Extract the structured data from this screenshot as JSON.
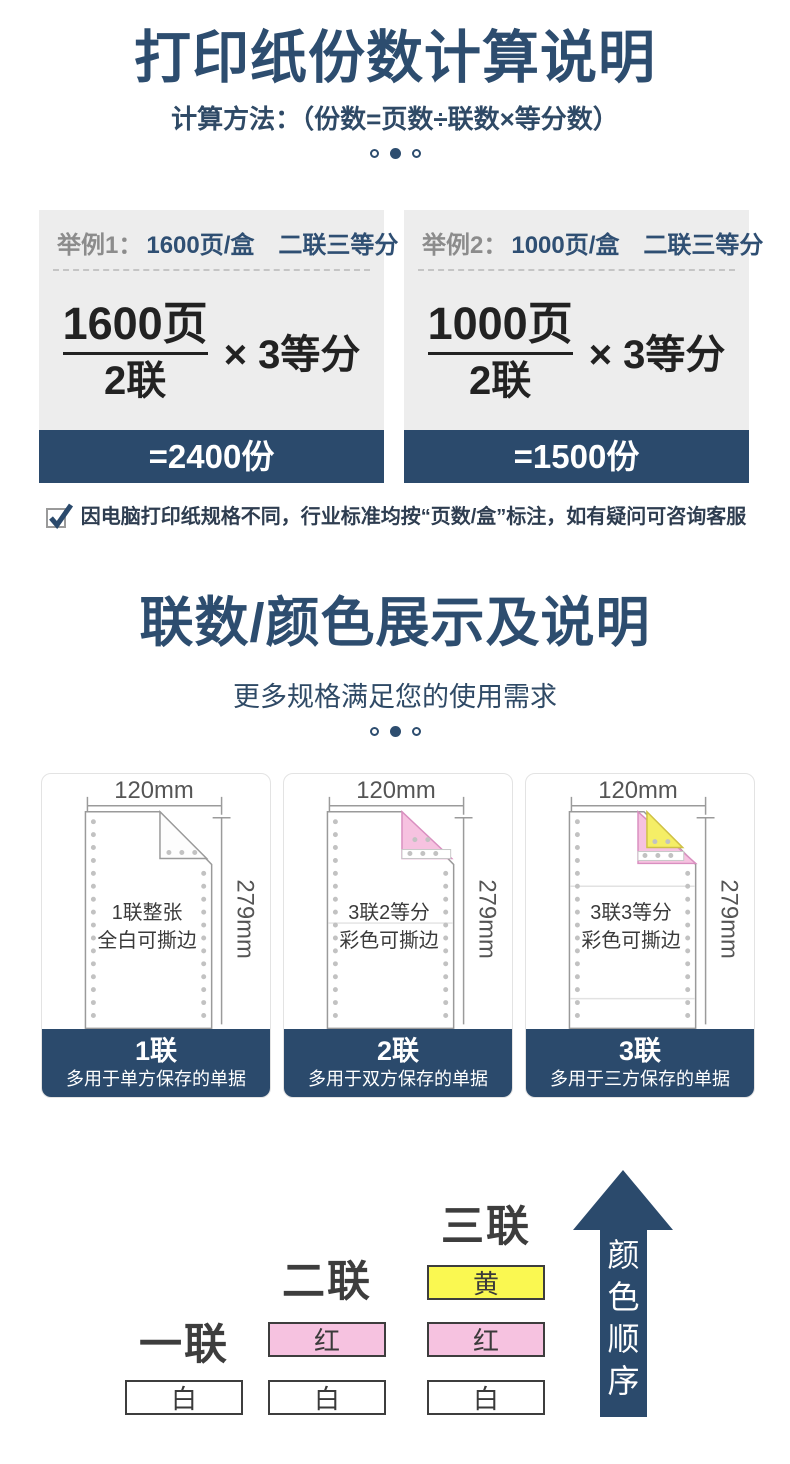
{
  "section1": {
    "title": "打印纸份数计算说明",
    "subtitle": "计算方法：（份数=页数÷联数×等分数）",
    "examples": [
      {
        "label": "举例1：",
        "spec": "1600页/盒　二联三等分",
        "numerator": "1600页",
        "denominator": "2联",
        "multiplier": "× 3等分",
        "result": "=2400份"
      },
      {
        "label": "举例2：",
        "spec": "1000页/盒　二联三等分",
        "numerator": "1000页",
        "denominator": "2联",
        "multiplier": "× 3等分",
        "result": "=1500份"
      }
    ],
    "note": "因电脑打印纸规格不同，行业标准均按“页数/盒”标注，如有疑问可咨询客服"
  },
  "section2": {
    "title": "联数/颜色展示及说明",
    "subtitle": "更多规格满足您的使用需求",
    "cards": [
      {
        "width_label": "120mm",
        "height_label": "279mm",
        "desc_line1": "1联整张",
        "desc_line2": "全白可撕边",
        "ply_label": "1联",
        "usage": "多用于单方保存的单据"
      },
      {
        "width_label": "120mm",
        "height_label": "279mm",
        "desc_line1": "3联2等分",
        "desc_line2": "彩色可撕边",
        "ply_label": "2联",
        "usage": "多用于双方保存的单据"
      },
      {
        "width_label": "120mm",
        "height_label": "279mm",
        "desc_line1": "3联3等分",
        "desc_line2": "彩色可撕边",
        "ply_label": "3联",
        "usage": "多用于三方保存的单据"
      }
    ]
  },
  "color_order": {
    "columns": [
      {
        "label": "一联",
        "stack": [
          "白"
        ]
      },
      {
        "label": "二联",
        "stack": [
          "红",
          "白"
        ]
      },
      {
        "label": "三联",
        "stack": [
          "黄",
          "红",
          "白"
        ]
      }
    ],
    "arrow_label": "颜色顺序"
  },
  "colors": {
    "navy": "#2b4a6c",
    "title_navy": "#2d4d6f",
    "example_bg": "#ededed",
    "yellow": "#faf851",
    "pink": "#f6c2e0"
  }
}
